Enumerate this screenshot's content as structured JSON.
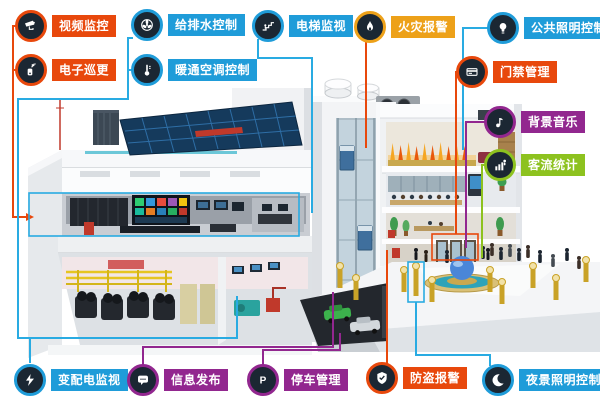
{
  "palette": {
    "red_orange": "#e8480c",
    "blue": "#1f9cd9",
    "amber": "#eda119",
    "purple": "#92278f",
    "green": "#8dc21f",
    "icon_bg": "#1b2733",
    "line_cyan": "#29abe2"
  },
  "callouts": {
    "video_surveillance": {
      "label": "视频监控",
      "color": "#e8480c",
      "icon": "cctv-camera-icon"
    },
    "electronic_patrol": {
      "label": "电子巡更",
      "color": "#e8480c",
      "icon": "patrol-device-icon"
    },
    "water_supply": {
      "label": "给排水控制",
      "color": "#1f9cd9",
      "icon": "pump-fan-icon"
    },
    "hvac_control": {
      "label": "暖通空调控制",
      "color": "#1f9cd9",
      "icon": "thermostat-icon"
    },
    "elevator_monitor": {
      "label": "电梯监视",
      "color": "#1f9cd9",
      "icon": "escalator-icon"
    },
    "fire_alarm": {
      "label": "火灾报警",
      "color": "#eda119",
      "icon": "flame-icon"
    },
    "public_lighting": {
      "label": "公共照明控制",
      "color": "#1f9cd9",
      "icon": "light-bulb-icon"
    },
    "access_control": {
      "label": "门禁管理",
      "color": "#e8480c",
      "icon": "access-card-icon"
    },
    "background_music": {
      "label": "背景音乐",
      "color": "#92278f",
      "icon": "music-note-icon"
    },
    "passenger_flow": {
      "label": "客流统计",
      "color": "#8dc21f",
      "icon": "people-stats-icon"
    },
    "power_monitoring": {
      "label": "变配电监视",
      "color": "#1f9cd9",
      "icon": "lightning-icon"
    },
    "info_release": {
      "label": "信息发布",
      "color": "#92278f",
      "icon": "message-bubble-icon"
    },
    "parking_management": {
      "label": "停车管理",
      "color": "#92278f",
      "icon": "parking-icon"
    },
    "burglar_alarm": {
      "label": "防盗报警",
      "color": "#e8480c",
      "icon": "shield-icon"
    },
    "night_lighting": {
      "label": "夜景照明控制",
      "color": "#1f9cd9",
      "icon": "moon-icon"
    }
  }
}
